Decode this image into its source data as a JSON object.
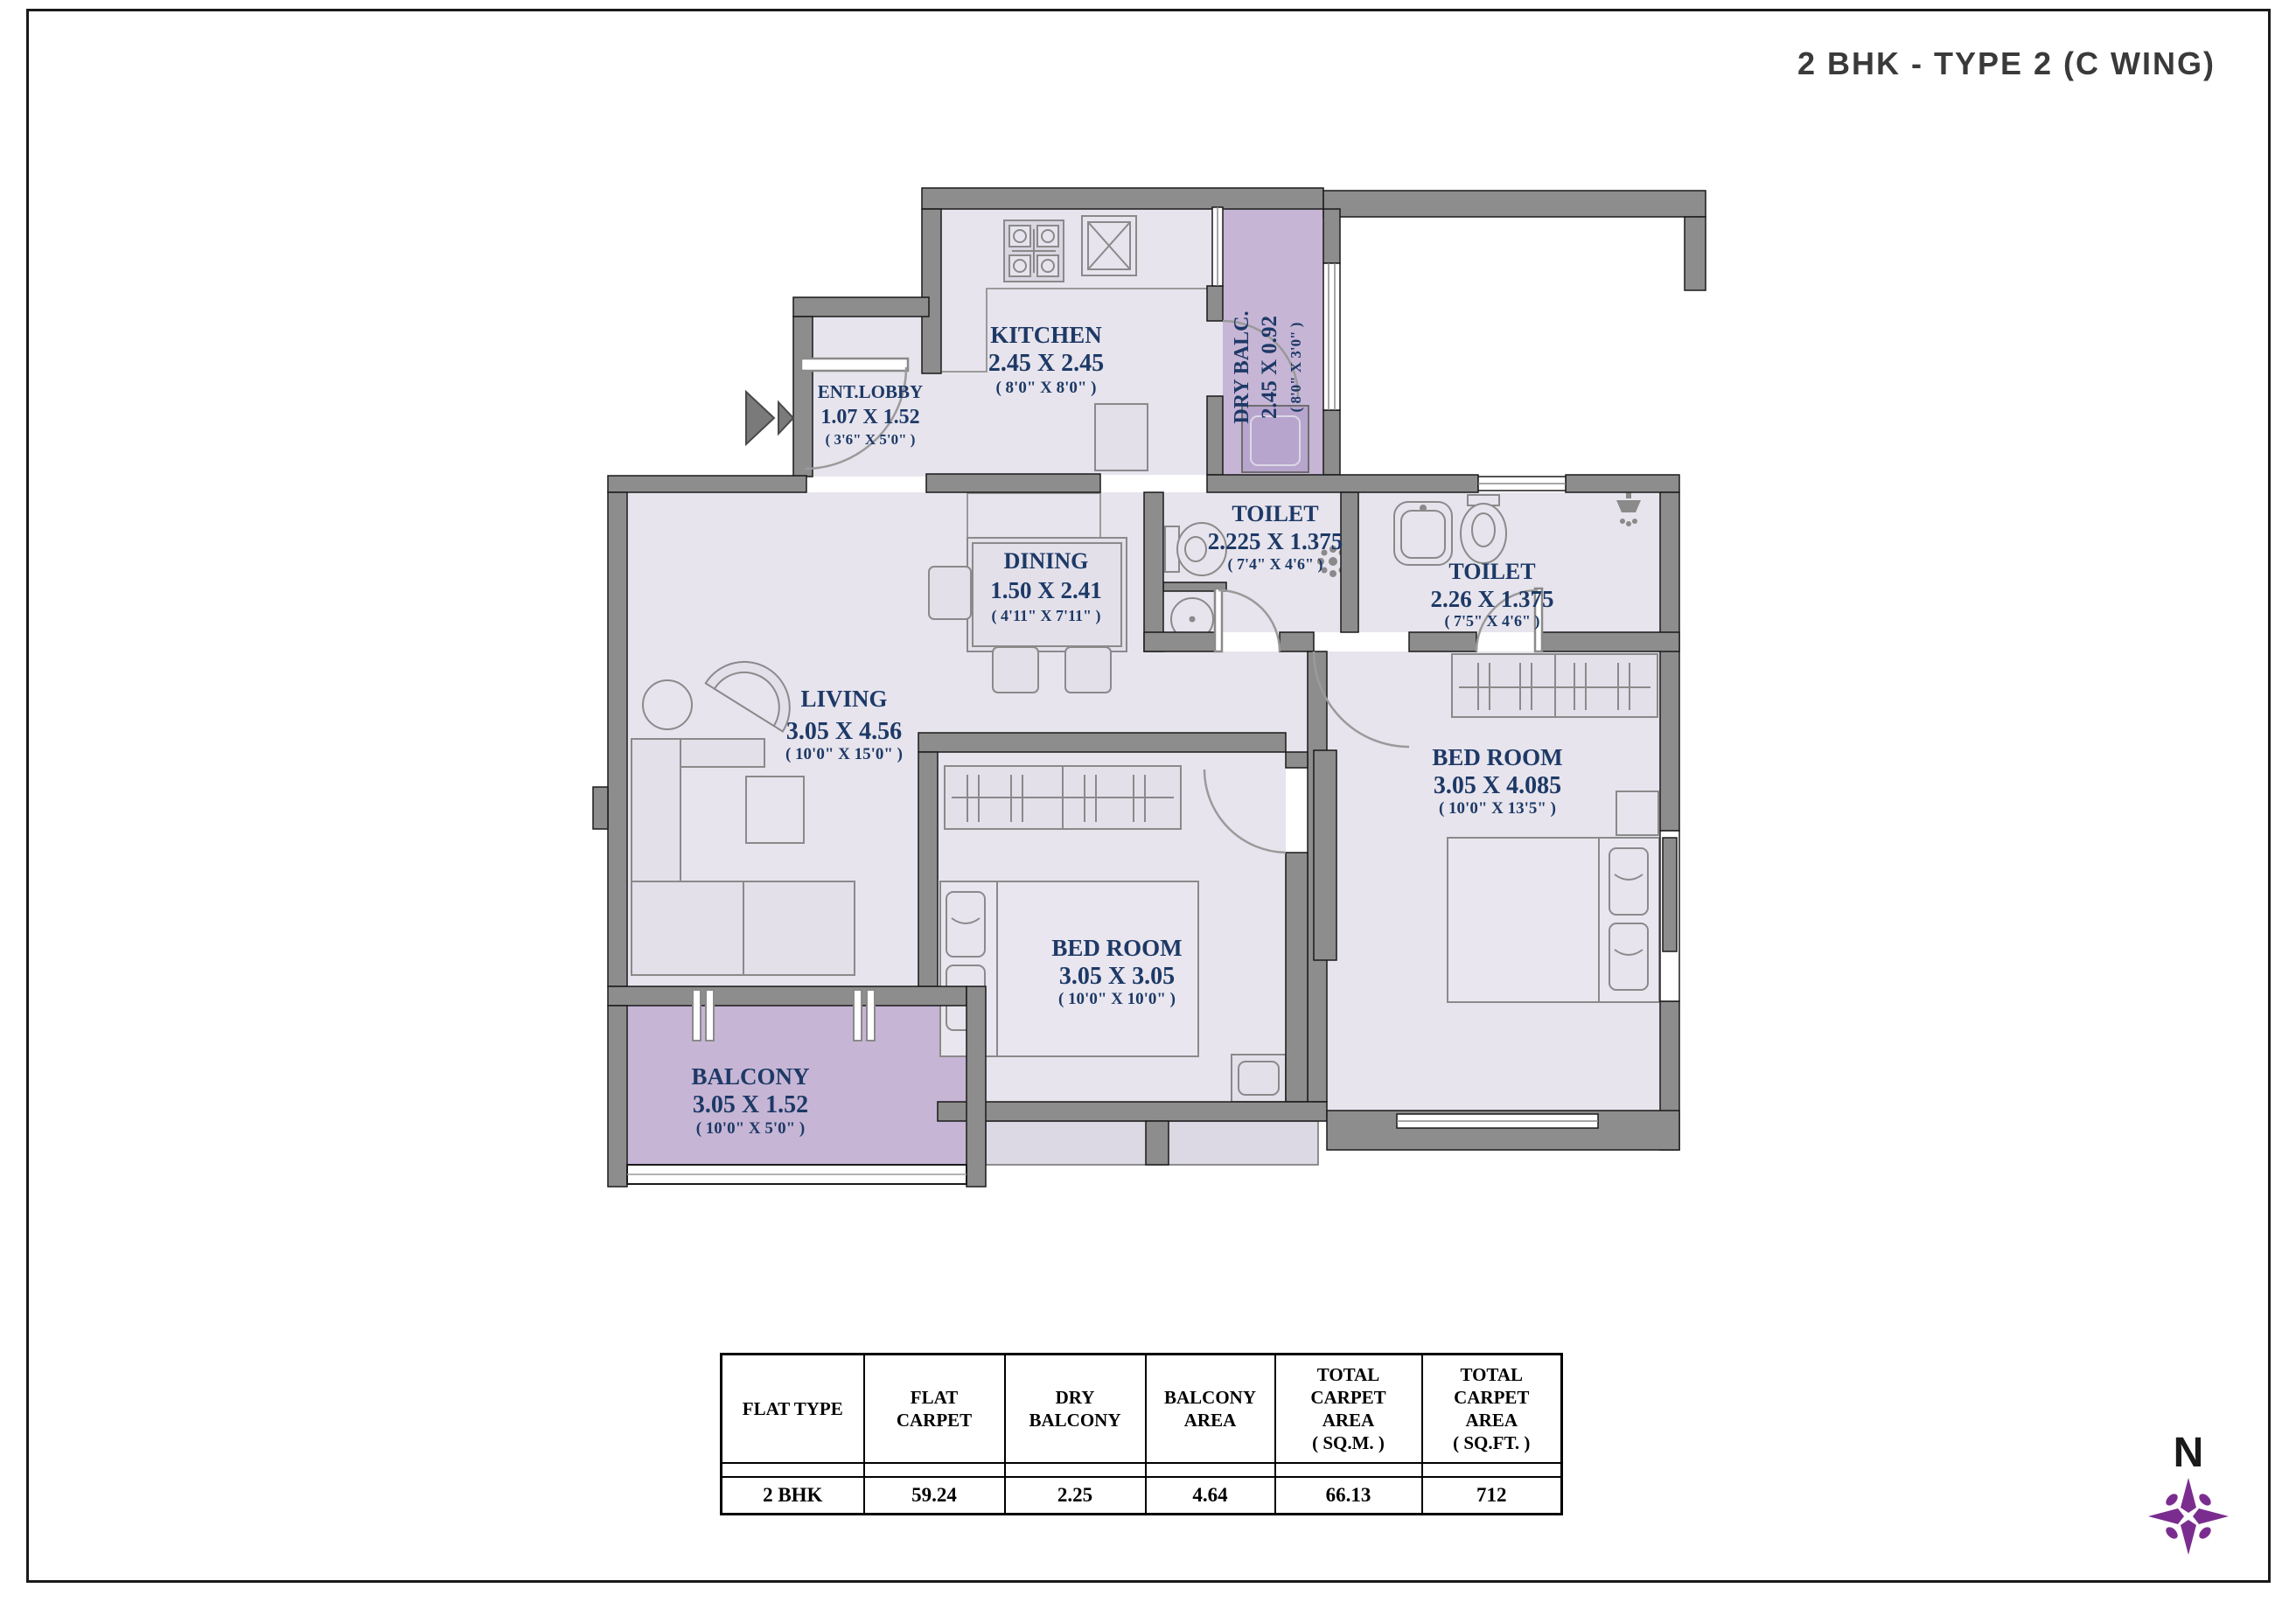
{
  "title": "2 BHK - TYPE 2 (C WING)",
  "compass": {
    "label": "N",
    "color": "#7b2d8f"
  },
  "colors": {
    "room_fill": "#e7e4ed",
    "accent_fill": "#c6b5d5",
    "wall": "#8d8d8d",
    "label_navy": "#1d3966"
  },
  "rooms": [
    {
      "id": "ent-lobby",
      "name": "ENT.LOBBY",
      "dim_m": "1.07 X 1.52",
      "dim_ft": "( 3'6\" X 5'0\" )"
    },
    {
      "id": "kitchen",
      "name": "KITCHEN",
      "dim_m": "2.45 X 2.45",
      "dim_ft": "( 8'0\" X 8'0\" )"
    },
    {
      "id": "dry-balcony",
      "name": "DRY BALC.",
      "dim_m": "2.45 X 0.92",
      "dim_ft": "( 8'0\" X 3'0\" )"
    },
    {
      "id": "dining",
      "name": "DINING",
      "dim_m": "1.50 X 2.41",
      "dim_ft": "( 4'11\" X 7'11\" )"
    },
    {
      "id": "toilet-1",
      "name": "TOILET",
      "dim_m": "2.225 X 1.375",
      "dim_ft": "( 7'4\" X 4'6\" )"
    },
    {
      "id": "toilet-2",
      "name": "TOILET",
      "dim_m": "2.26 X 1.375",
      "dim_ft": "( 7'5\" X 4'6\" )"
    },
    {
      "id": "living",
      "name": "LIVING",
      "dim_m": "3.05 X 4.56",
      "dim_ft": "( 10'0\" X 15'0\" )"
    },
    {
      "id": "bedroom-master",
      "name": "BED ROOM",
      "dim_m": "3.05 X 4.085",
      "dim_ft": "( 10'0\" X 13'5\" )"
    },
    {
      "id": "bedroom-2",
      "name": "BED ROOM",
      "dim_m": "3.05 X 3.05",
      "dim_ft": "( 10'0\" X 10'0\" )"
    },
    {
      "id": "balcony",
      "name": "BALCONY",
      "dim_m": "3.05 X 1.52",
      "dim_ft": "( 10'0\" X 5'0\" )"
    }
  ],
  "area_table": {
    "headers": [
      "FLAT TYPE",
      "FLAT\nCARPET",
      "DRY\nBALCONY",
      "BALCONY\nAREA",
      "TOTAL\nCARPET\nAREA\n( SQ.M. )",
      "TOTAL\nCARPET\nAREA\n( SQ.FT. )"
    ],
    "rows": [
      [
        "2 BHK",
        "59.24",
        "2.25",
        "4.64",
        "66.13",
        "712"
      ]
    ]
  }
}
